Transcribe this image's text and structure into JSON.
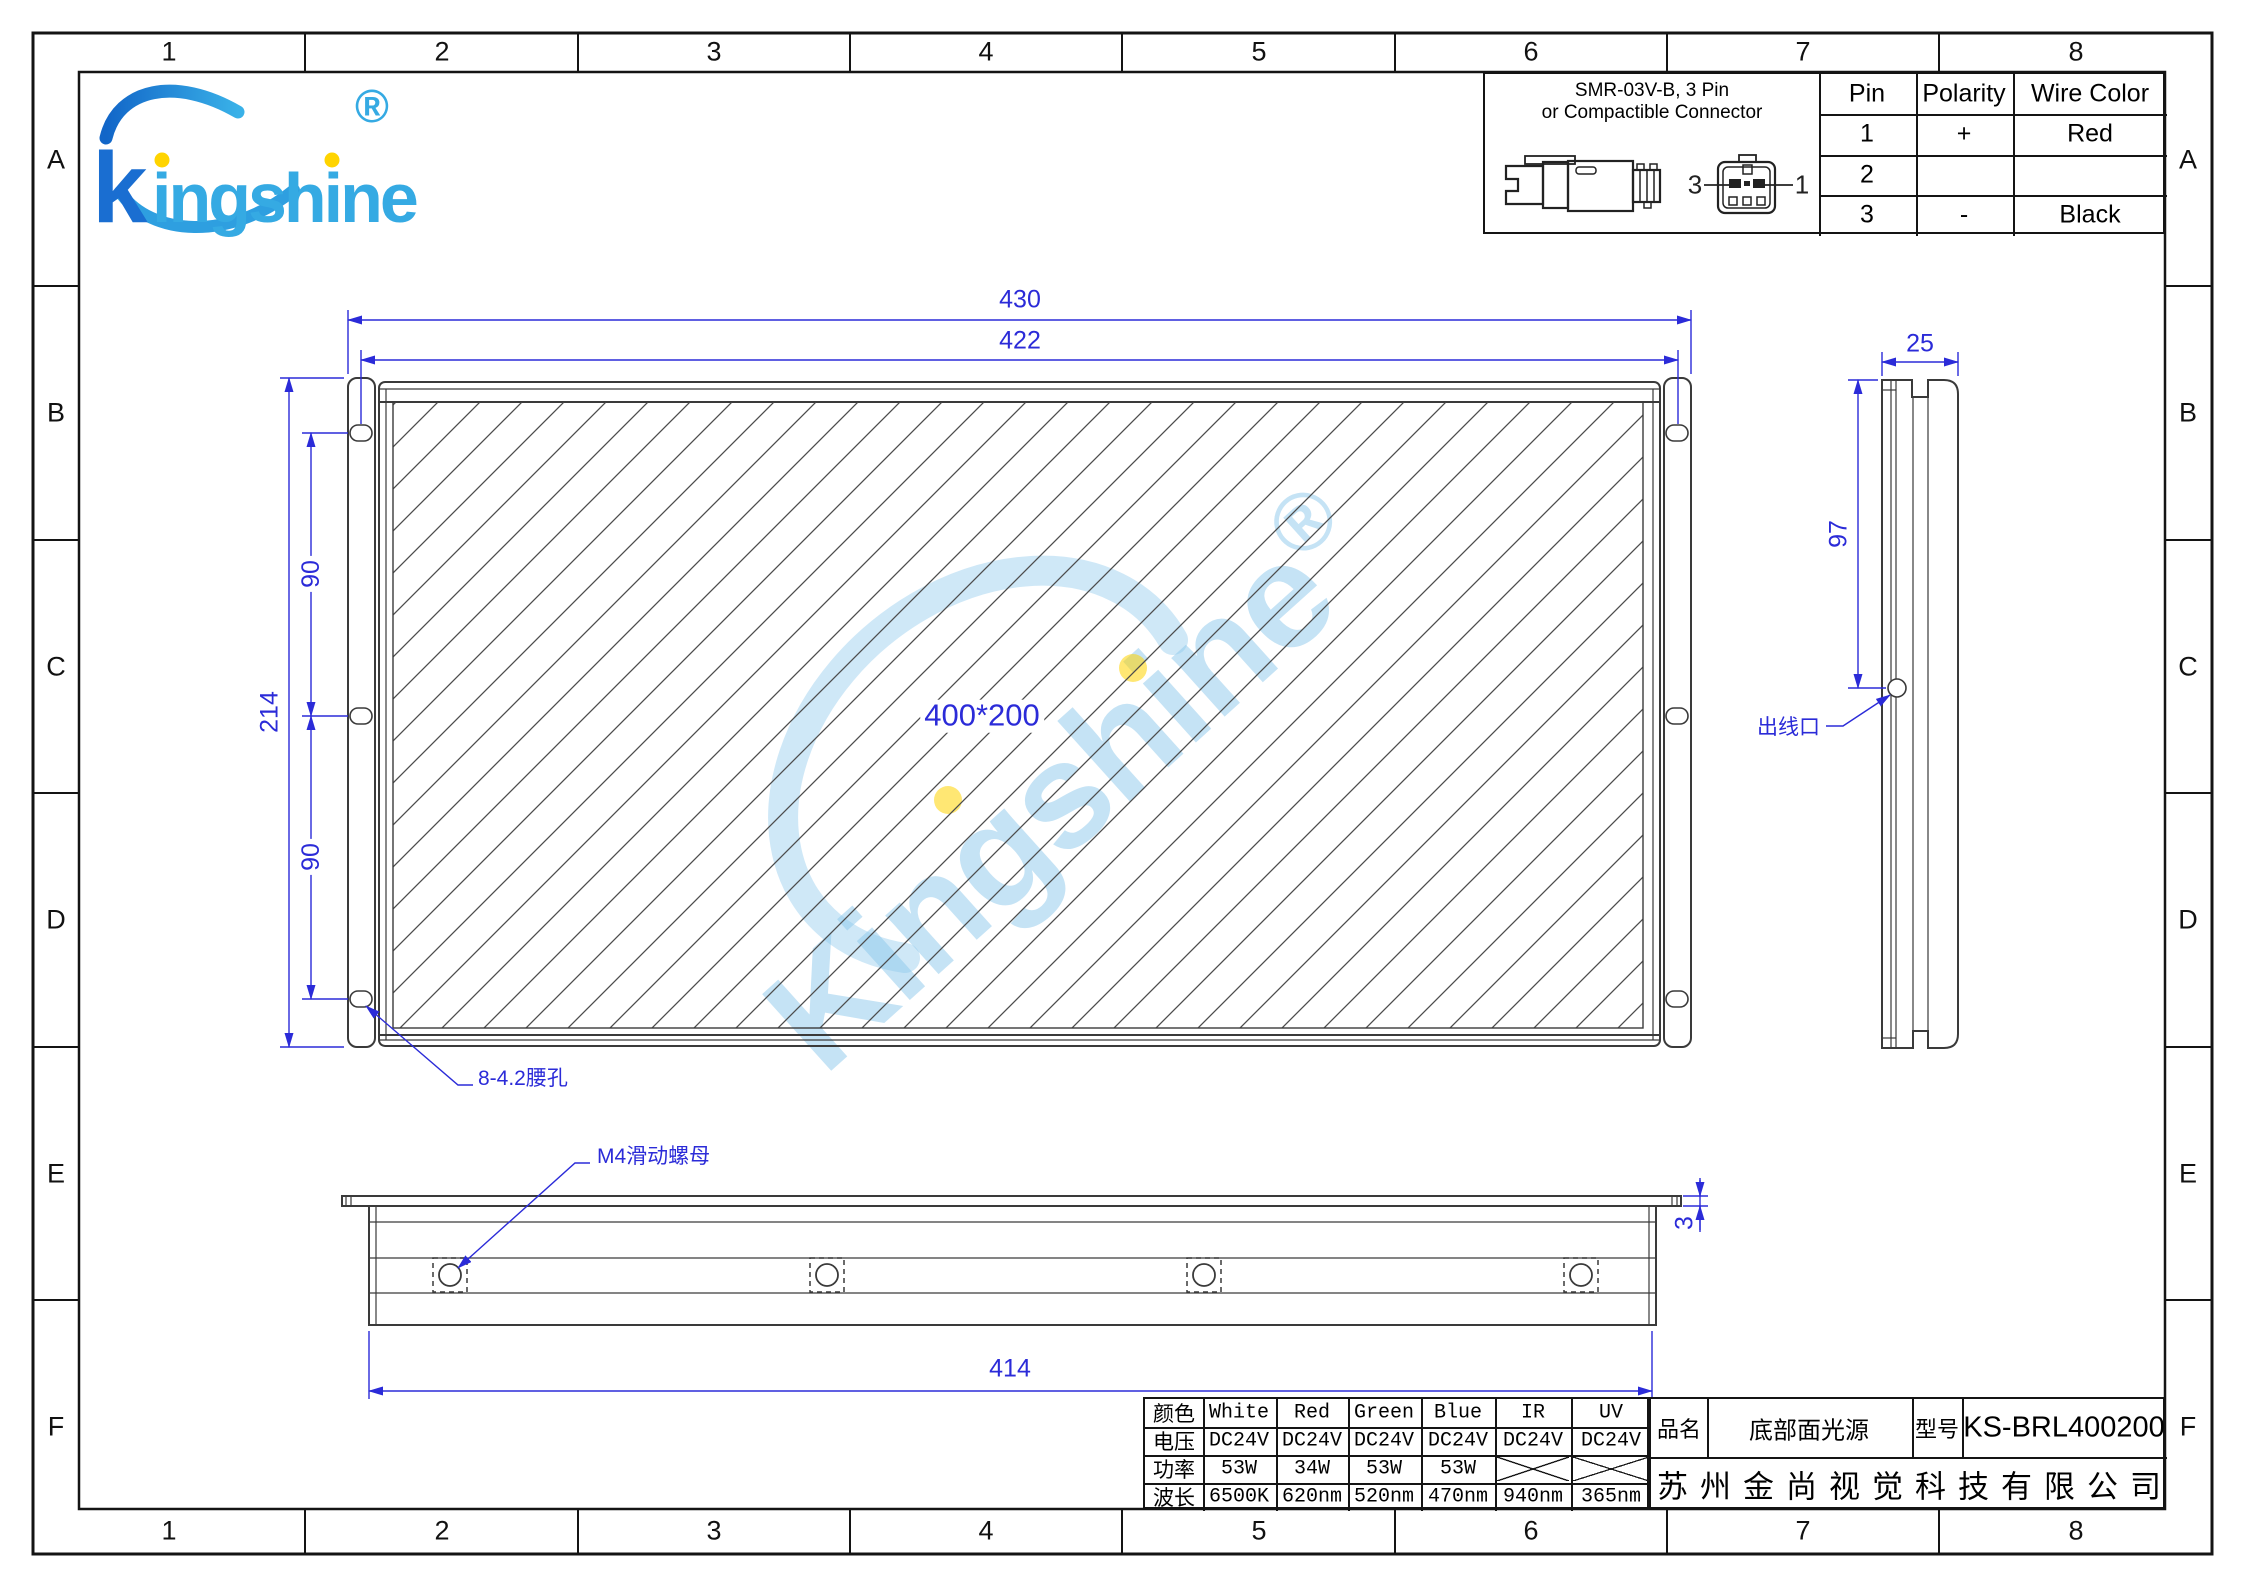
{
  "grid": {
    "columns": [
      "1",
      "2",
      "3",
      "4",
      "5",
      "6",
      "7",
      "8"
    ],
    "rows": [
      "A",
      "B",
      "C",
      "D",
      "E",
      "F"
    ]
  },
  "logo": {
    "k": "k",
    "rest": "ingshine",
    "registered": "®"
  },
  "watermark": {
    "text": "Kingshine",
    "registered": "®"
  },
  "connector_panel": {
    "title_line1": "SMR-03V-B, 3 Pin",
    "title_line2": "or Compactible Connector",
    "face_label_left": "3",
    "face_label_right": "1",
    "table": {
      "headers": [
        "Pin",
        "Polarity",
        "Wire Color"
      ],
      "rows": [
        [
          "1",
          "+",
          "Red"
        ],
        [
          "2",
          "",
          ""
        ],
        [
          "3",
          "-",
          "Black"
        ]
      ]
    }
  },
  "front_view": {
    "dim_overall_width": "430",
    "dim_hole_span": "422",
    "dim_overall_height": "214",
    "dim_hole_pitch_top": "90",
    "dim_hole_pitch_bottom": "90",
    "emitting_area": "400*200",
    "slot_callout": "8-4.2腰孔"
  },
  "side_view": {
    "dim_width": "25",
    "dim_outlet_height": "97",
    "outlet_callout": "出线口"
  },
  "bottom_view": {
    "nut_callout": "M4滑动螺母",
    "dim_length": "414",
    "dim_plate_thickness": "3"
  },
  "spec_table": {
    "row_headers": [
      "颜色",
      "电压",
      "功率",
      "波长"
    ],
    "columns": [
      "White",
      "Red",
      "Green",
      "Blue",
      "IR",
      "UV"
    ],
    "voltage": [
      "DC24V",
      "DC24V",
      "DC24V",
      "DC24V",
      "DC24V",
      "DC24V"
    ],
    "power": [
      "53W",
      "34W",
      "53W",
      "53W",
      "",
      ""
    ],
    "wavelength": [
      "6500K",
      "620nm",
      "520nm",
      "470nm",
      "940nm",
      "365nm"
    ]
  },
  "title_block": {
    "name_label": "品名",
    "name_value": "底部面光源",
    "model_label": "型号",
    "model_value": "KS-BRL400200",
    "company": "苏州金尚视觉科技有限公司"
  },
  "colors": {
    "dimension_blue": "#2b2bd8",
    "line_gray": "#3a3a3a",
    "logo_dark_blue": "#1a6ed1",
    "logo_light_blue": "#35aae3",
    "dot_yellow": "#ffd400",
    "watermark_blue": "#8cc8ec"
  }
}
